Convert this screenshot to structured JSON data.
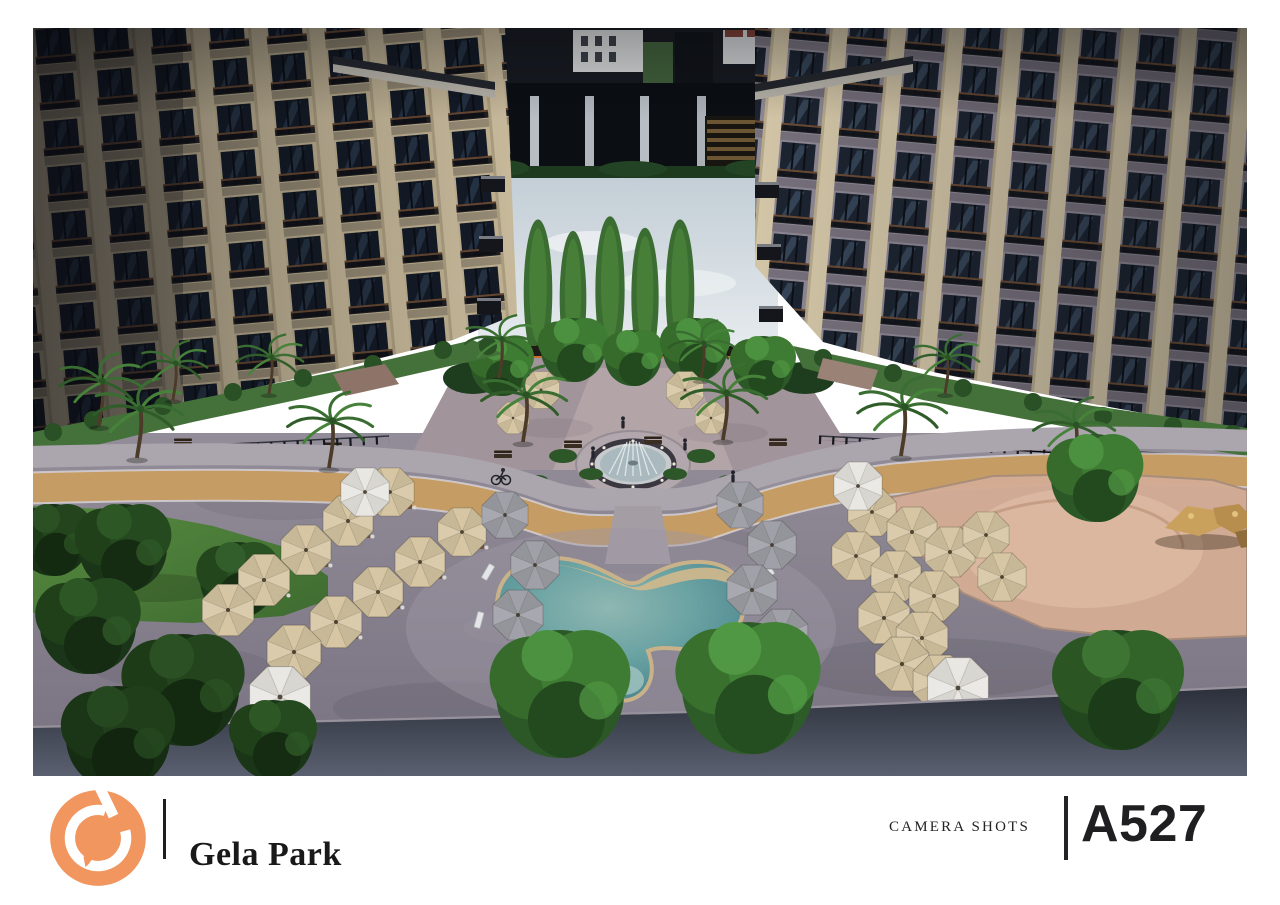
{
  "titleblock": {
    "project_title": "Gela Park",
    "sheet_category": "CAMERA SHOTS",
    "sheet_number": "A527"
  },
  "branding": {
    "logo_icon": "gela-g-monogram",
    "logo_color": "#F0965E"
  },
  "render": {
    "type": "3d-aerial-render",
    "subject": "Aerial camera shot of the Gela Park residential courtyard: two apartment blocks framing a landscaped plaza with a circular splash fountain, a tan jogging loop, a freeform swimming pool with kids' cove, rows of cream and grey patio umbrellas, palm trees, a lawn on the left and a sand play area with rocks on the right."
  },
  "palette": {
    "background": "#FFFFFF",
    "ink": "#1E1E20",
    "divider": "#232325",
    "pool_water": "#5E9AA0",
    "pool_beach": "#D2B88C",
    "track": "#C59C63",
    "pavement": "#8D8793",
    "umbrella_cream": "#D6C6A3",
    "umbrella_grey": "#9FA0A8",
    "umbrella_white": "#E9E7E2",
    "lawn": "#4E7D3A",
    "sand": "#D3AC94",
    "sky": "#CBD5DC",
    "pergola_orange": "#C8702E"
  }
}
